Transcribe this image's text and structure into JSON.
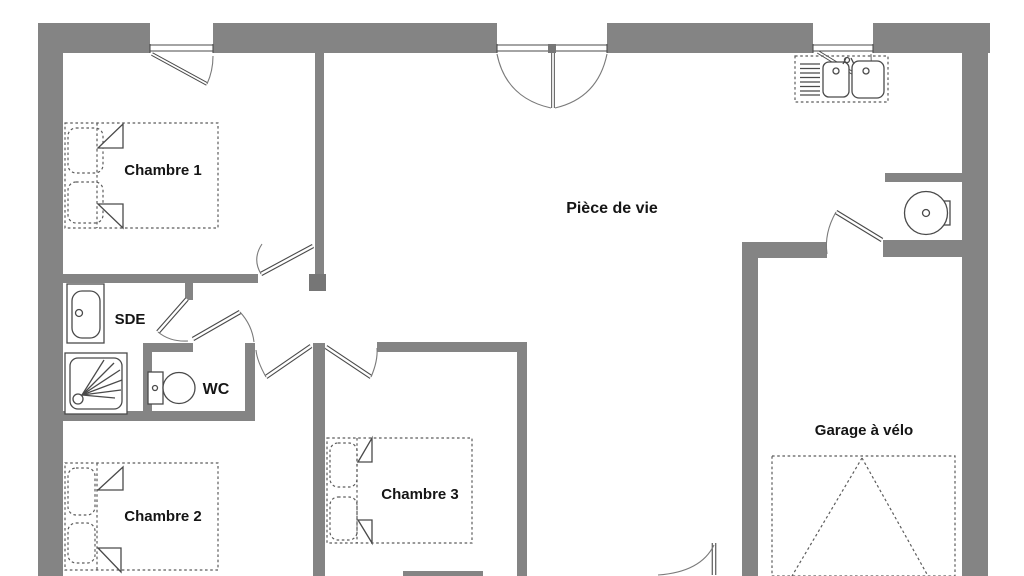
{
  "plan": {
    "type": "floor-plan",
    "language": "fr",
    "rooms": [
      {
        "id": "chambre1",
        "label": "Chambre 1"
      },
      {
        "id": "piece_de_vie",
        "label": "Pièce de vie"
      },
      {
        "id": "sde",
        "label": "SDE"
      },
      {
        "id": "wc",
        "label": "WC"
      },
      {
        "id": "chambre2",
        "label": "Chambre 2"
      },
      {
        "id": "chambre3",
        "label": "Chambre 3"
      },
      {
        "id": "garage",
        "label": "Garage à vélo"
      }
    ]
  },
  "fixtures": [
    "double-bed-icon",
    "pillow-icon",
    "shower-icon",
    "washbasin-icon",
    "toilet-icon",
    "kitchen-double-sink-icon",
    "faucet-icon",
    "water-heater-icon",
    "door-swing-icon",
    "window-casement-icon",
    "french-doors-icon",
    "garage-door-swing-icon"
  ],
  "colors": {
    "background": "#ffffff",
    "wall": "#848484",
    "wall_post": "#767676",
    "line": "#4a4a4a",
    "line_dash": "#5c5c5c",
    "line_arc": "#7a7a7a",
    "text": "#151515"
  }
}
